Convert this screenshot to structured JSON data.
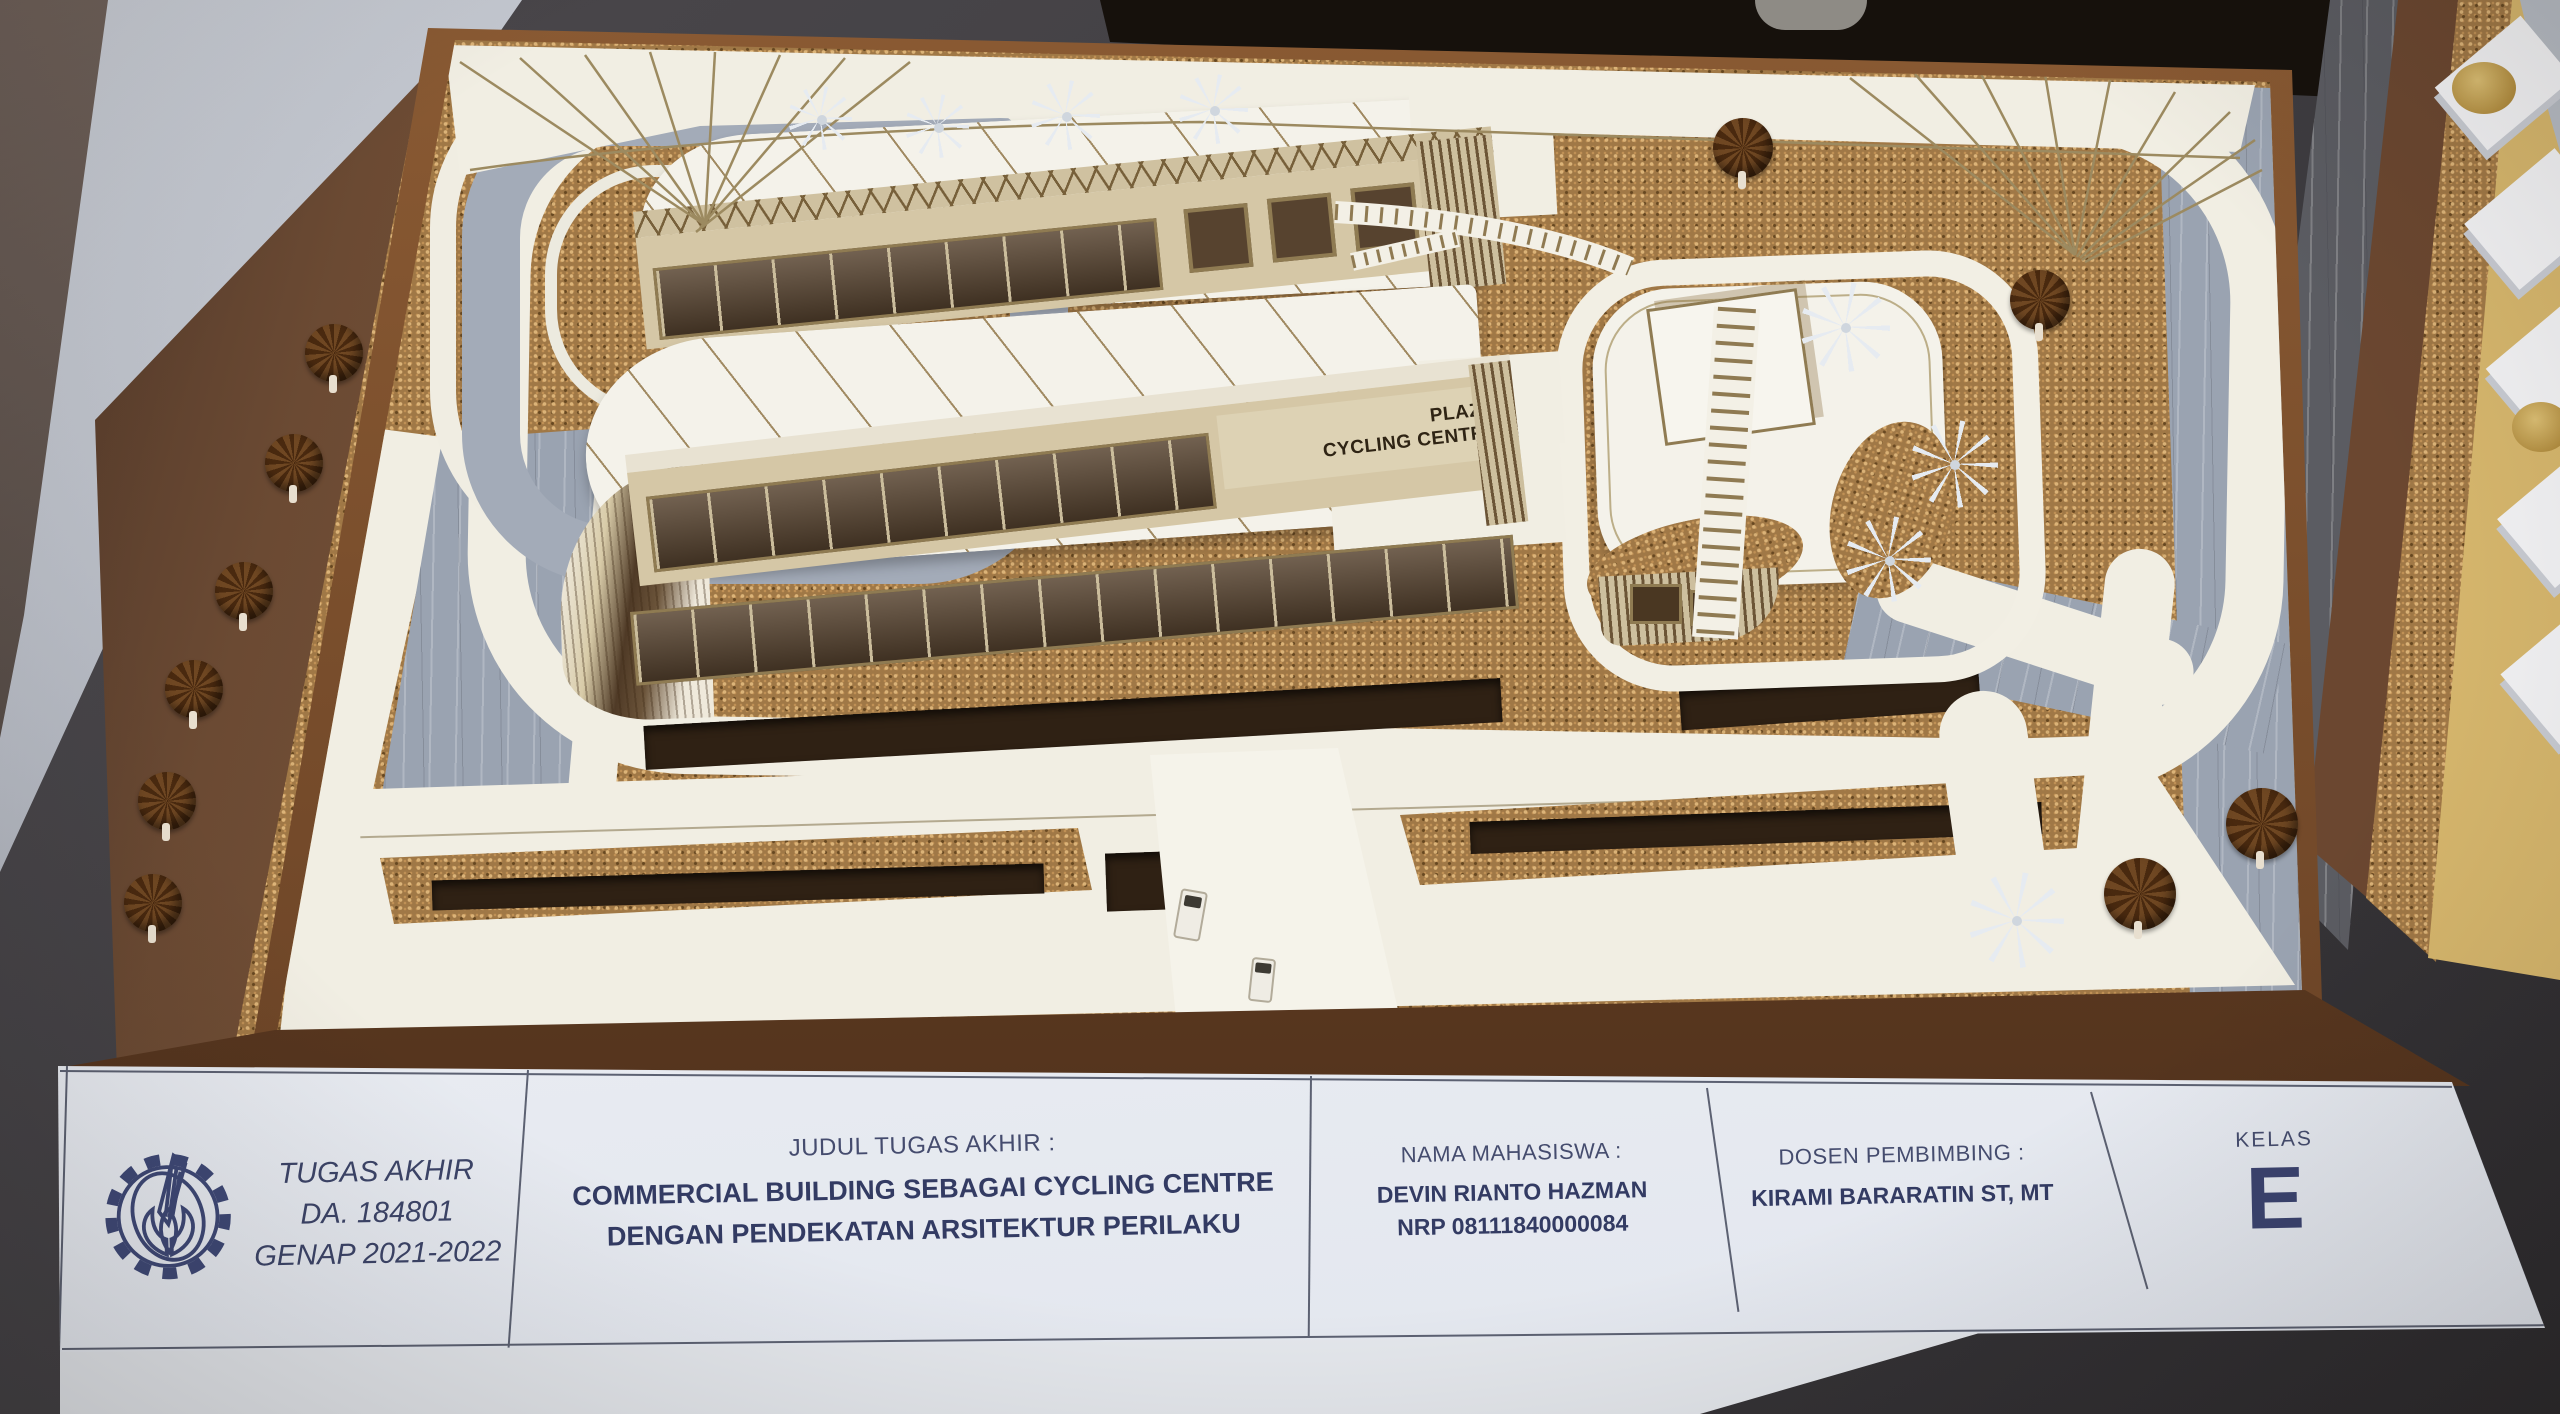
{
  "palette": {
    "cork_ground": "#a07846",
    "road_gray": "#9aa3b1",
    "model_paper": "#f1eee3",
    "facade_tan": "#d5c7a6",
    "glass_dark": "#57432f",
    "base_wood": "#6e4527",
    "card_paper": "#eef0f5",
    "card_ink": "#363e66"
  },
  "building_sign": {
    "line1": "PLAZA",
    "line2": "CYCLING CENTRE"
  },
  "title_card": {
    "cells": [
      {
        "id": "project",
        "lines": [
          "TUGAS AKHIR",
          "DA. 184801",
          "GENAP 2021-2022"
        ]
      },
      {
        "id": "judul",
        "header": "JUDUL TUGAS AKHIR :",
        "lines": [
          "COMMERCIAL BUILDING SEBAGAI CYCLING CENTRE",
          "DENGAN PENDEKATAN ARSITEKTUR PERILAKU"
        ]
      },
      {
        "id": "mahasiswa",
        "header": "NAMA MAHASISWA :",
        "lines": [
          "DEVIN RIANTO HAZMAN",
          "NRP 08111840000084"
        ]
      },
      {
        "id": "dosen",
        "header": "DOSEN PEMBIMBING :",
        "lines": [
          "KIRAMI BARARATIN ST, MT"
        ]
      },
      {
        "id": "kelas",
        "header": "KELAS",
        "lines": [
          "E"
        ]
      }
    ]
  }
}
